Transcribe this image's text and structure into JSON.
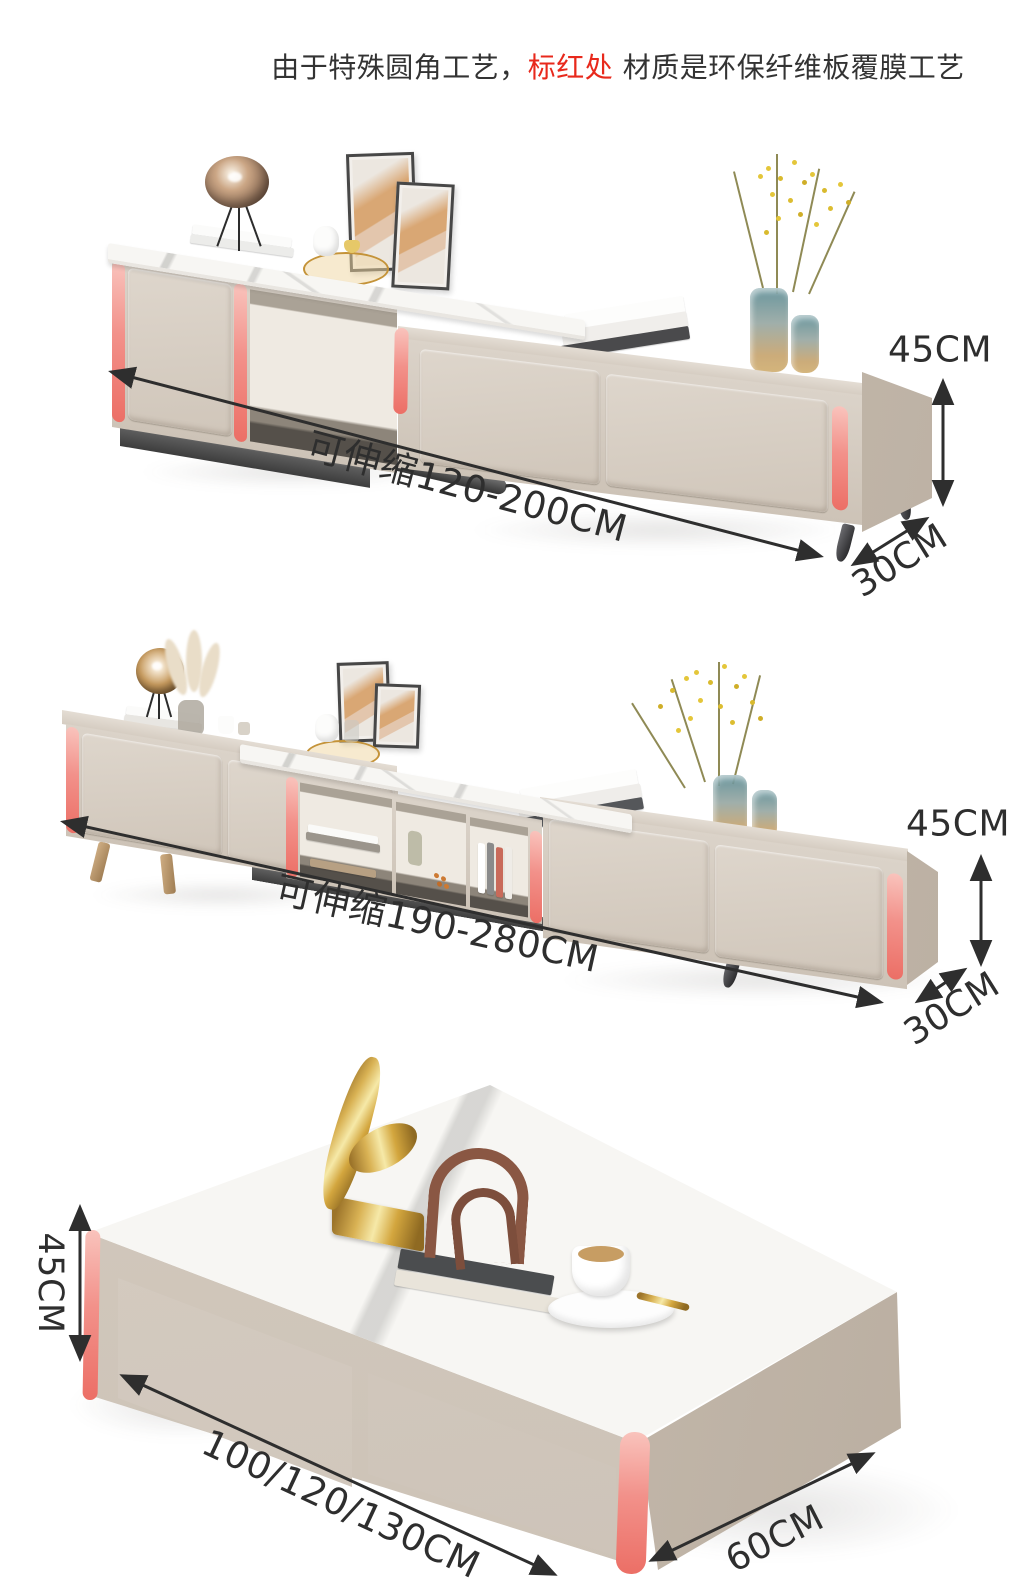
{
  "header": {
    "prefix": "由于特殊圆角工艺，",
    "highlight": "标红处",
    "suffix": " 材质是环保纤维板覆膜工艺"
  },
  "products": [
    {
      "name": "extendable-tv-stand-120-200",
      "range_label": "可伸缩120-200CM",
      "height_label": "45CM",
      "depth_label": "30CM"
    },
    {
      "name": "extendable-tv-stand-190-280",
      "range_label": "可伸缩190-280CM",
      "height_label": "45CM",
      "depth_label": "30CM"
    },
    {
      "name": "coffee-table",
      "length_label": "100/120/130CM",
      "height_label": "45CM",
      "depth_label": "60CM"
    }
  ],
  "colors": {
    "highlight_red": "#e8291c",
    "strip_pink": "#ee7d75",
    "body_greige": "#d3c9be",
    "marble_white": "#f6f5f3",
    "annotation": "#2e2e2e"
  }
}
